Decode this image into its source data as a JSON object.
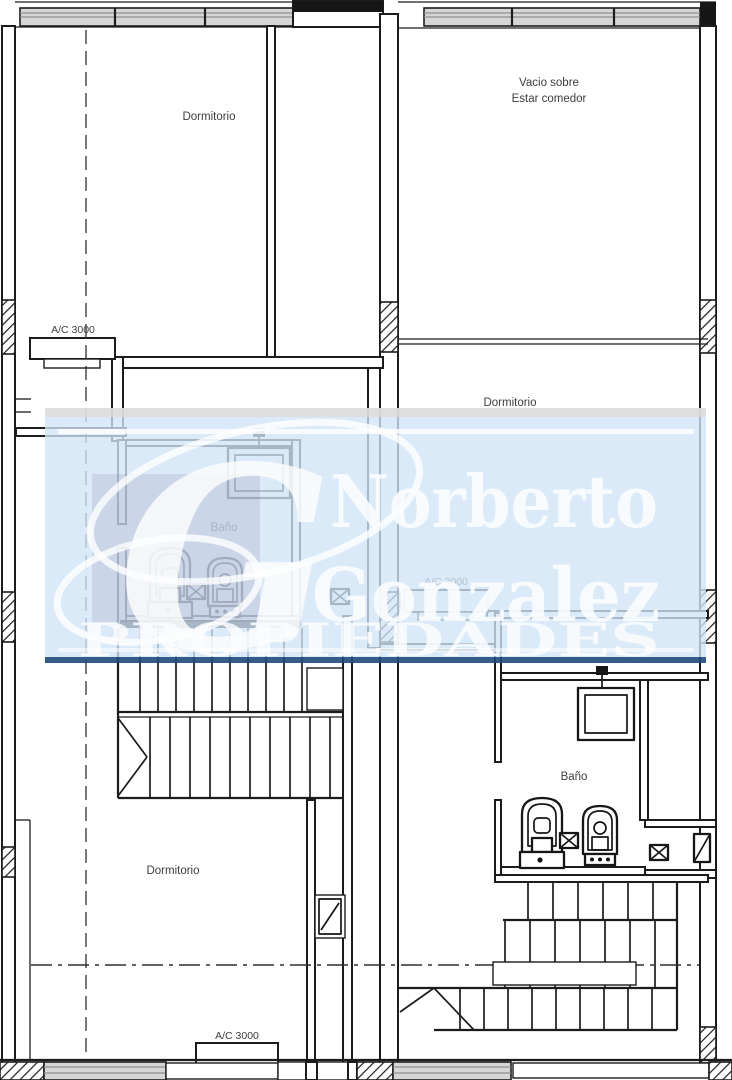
{
  "canvas": {
    "width": 732,
    "height": 1080,
    "background": "#ffffff",
    "line_color": "#1c1c1c"
  },
  "labels": {
    "dormitorio_top_left": "Dormitorio",
    "vacio_line1": "Vacio sobre",
    "vacio_line2": "Estar comedor",
    "dormitorio_right": "Dormitorio",
    "bano_left": "Baño",
    "bano_right": "Baño",
    "dormitorio_bottom_left": "Dormitorio",
    "ac_top_left": "A/C 3000",
    "ac_middle_right": "A/C 3000",
    "ac_bottom_left": "A/C 3000"
  },
  "watermark": {
    "name_line1": "Norberto",
    "name_line2": "Gonzalez",
    "tagline": "PROPIEDADES",
    "logo_letter": "G",
    "colors": {
      "panel_blue": "#cfe4f6",
      "panel_top_gray": "#dcdcdc",
      "accent_navy": "#1e4a7a",
      "text_white": "#ffffff"
    }
  }
}
